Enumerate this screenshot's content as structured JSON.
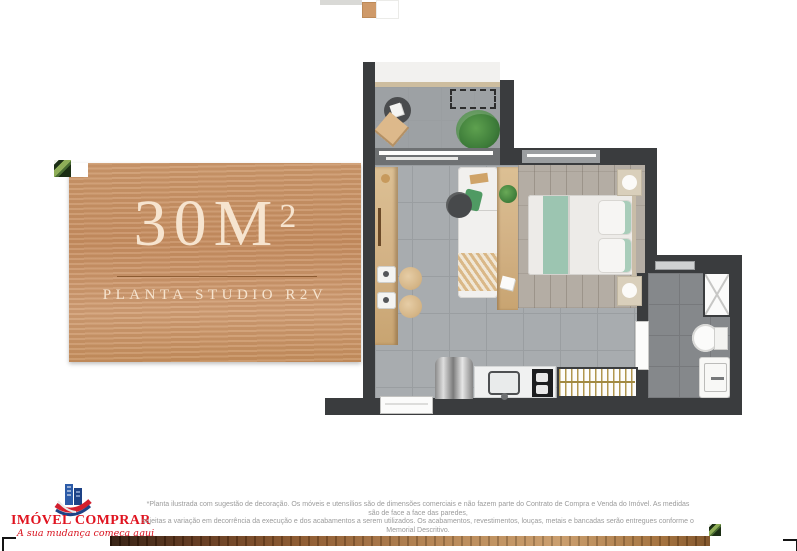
{
  "panel": {
    "area_value": "30M",
    "area_sup": "2",
    "subtitle": "PLANTA STUDIO R2V"
  },
  "logo": {
    "name": "IMÓVEL COMPRAR",
    "tagline": "A sua mudança começa aqui"
  },
  "disclaimer": {
    "line1": "*Planta ilustrada com sugestão de decoração. Os móveis e utensílios são de dimensões comerciais e não fazem parte do Contrato de Compra e Venda do Imóvel. As medidas são de face a face das paredes,",
    "line2": "sujeitas a variação em decorrência da execução e dos acabamentos a serem utilizados. Os acabamentos, revestimentos, louças, metais e bancadas serão entregues conforme o Memorial Descritivo."
  },
  "colors": {
    "panel_wood": "#cc9a70",
    "panel_text": "#f6e4cf",
    "logo_red": "#e0131f",
    "wall_dark": "#3a3c3e",
    "floor_tile": "#a8acaf",
    "accent_green": "#3e7d3a"
  }
}
